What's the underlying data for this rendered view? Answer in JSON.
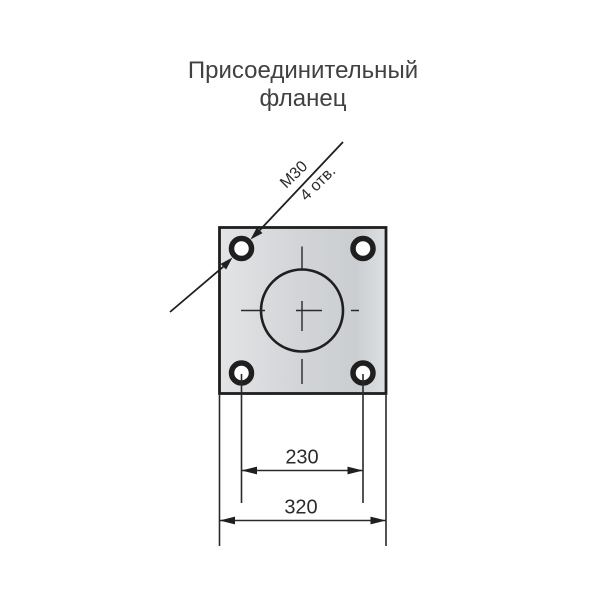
{
  "title": {
    "line1": "Присоединительный",
    "line2": "фланец"
  },
  "leader": {
    "thread": "М30",
    "holes_count": "4 отв."
  },
  "dimensions": {
    "bolt_spacing": "230",
    "plate_size": "320"
  },
  "colors": {
    "background": "#ffffff",
    "line": "#1f1f1f",
    "thin_line": "#2a2a2a",
    "title_text": "#414141",
    "dim_text": "#2b2b2b",
    "hole_fill": "#ffffff",
    "plate_light": "#e2e4e6",
    "plate_mid": "#d3d5d8",
    "plate_dark": "#cbced1",
    "plate_edge": "#dde0e2"
  }
}
